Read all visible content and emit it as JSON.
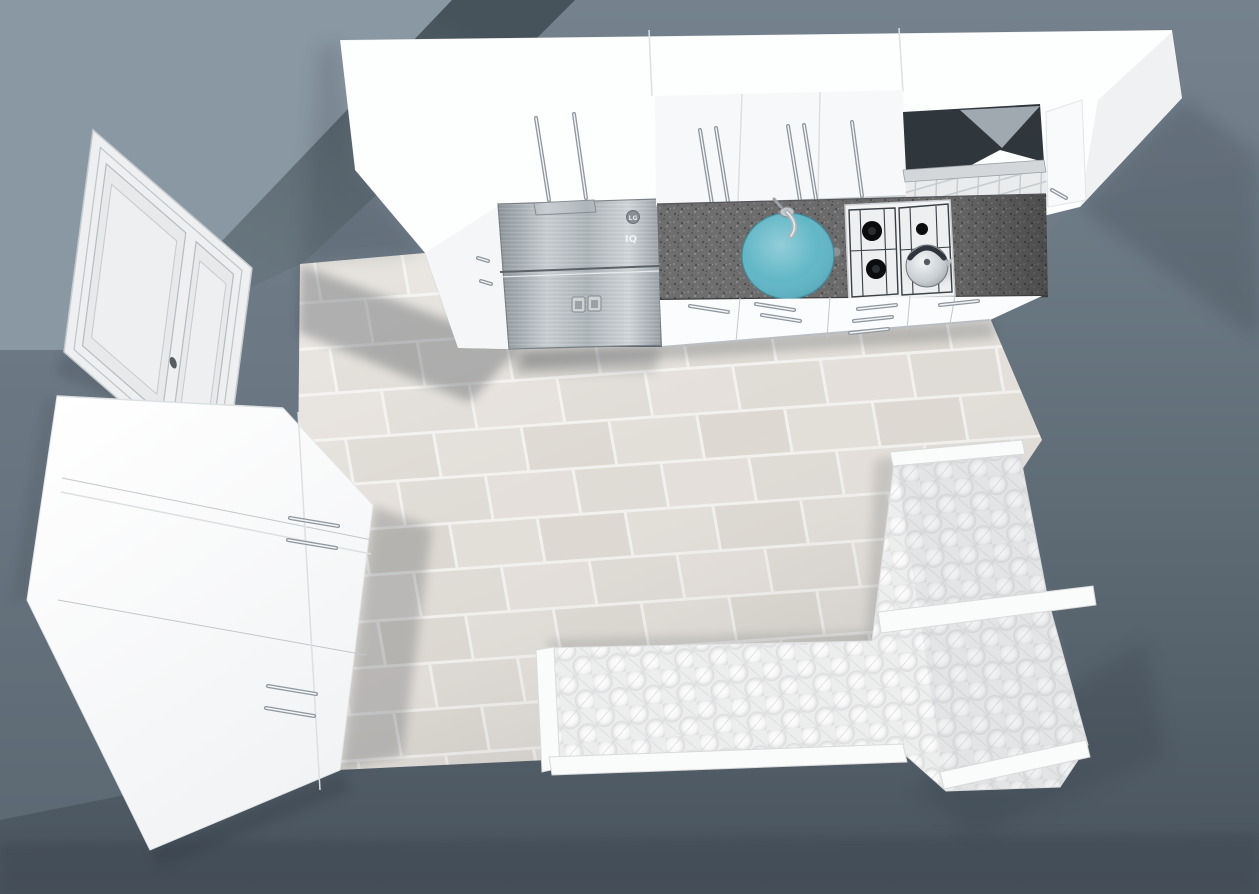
{
  "scene": {
    "type": "kitchen-3d-plan-top-view"
  },
  "colors": {
    "wall_light": "#8A98A3",
    "wall_shadow": "#56656F",
    "wall_base": "#73818C",
    "floor_dark": "#5A6771",
    "tile": "#DFDBD5",
    "grout": "#F2F1EE",
    "cabinet_white": "#FDFEFE",
    "counter": "#6E6E6E",
    "sink": "#59B3C4",
    "steel": "#AEB6BB",
    "sofa": "#ECEDED",
    "hood": "#2F363C",
    "door_face": "#EDEFF1"
  },
  "appliances": {
    "fridge_brand": "LG",
    "fridge_mark": "IQ"
  },
  "objects": {
    "door": "entry-door",
    "wardrobe": "tall-white-cabinet",
    "upper_cabinets": "white-upper-cabinets",
    "fridge": "stainless-refrigerator",
    "counter": "granite-countertop",
    "sink": "round-teal-sink",
    "hob": "gas-hob-4-burner",
    "kettle": "kettle-on-hob",
    "hood": "extractor-hood",
    "base_cabinets": "white-base-cabinets",
    "sofa": "white-tufted-corner-bench",
    "floor": "beige-tile-floor"
  }
}
